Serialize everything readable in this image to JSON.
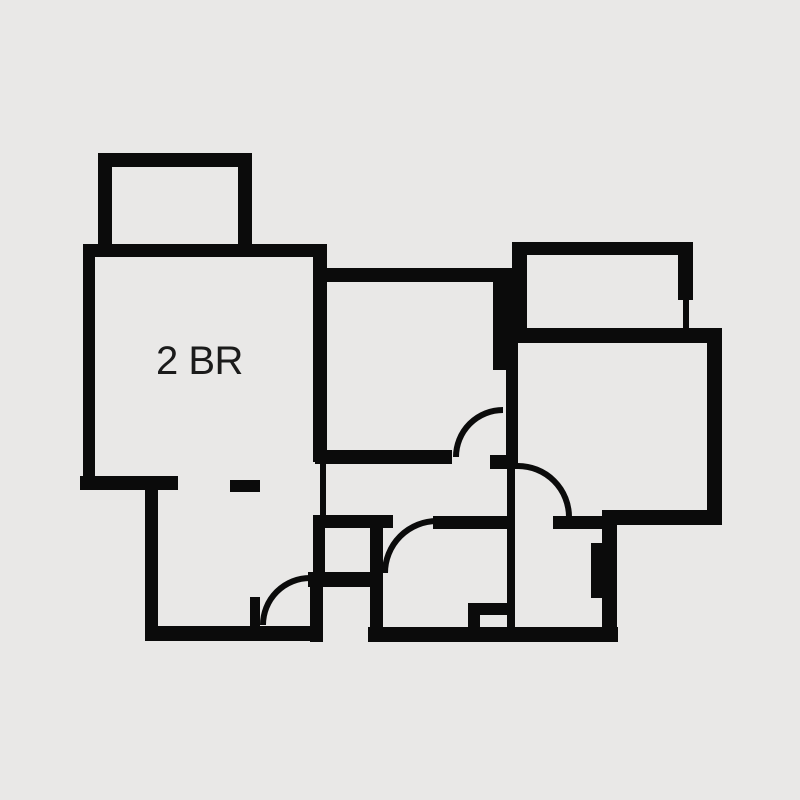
{
  "plan": {
    "label": "2 BR",
    "background_color": "#e9e8e7",
    "wall_color": "#0b0b0b",
    "label_color": "#1b1b1b",
    "door_stroke_width": 6,
    "walls": [
      {
        "name": "tl-balcony-top",
        "x": 98,
        "y": 153,
        "w": 154,
        "h": 14
      },
      {
        "name": "tl-balcony-left",
        "x": 98,
        "y": 167,
        "w": 14,
        "h": 78
      },
      {
        "name": "tl-balcony-right",
        "x": 238,
        "y": 167,
        "w": 14,
        "h": 78
      },
      {
        "name": "bedroom-top",
        "x": 83,
        "y": 244,
        "w": 244,
        "h": 13
      },
      {
        "name": "bedroom-left",
        "x": 83,
        "y": 244,
        "w": 12,
        "h": 246
      },
      {
        "name": "left-step",
        "x": 80,
        "y": 476,
        "w": 98,
        "h": 14
      },
      {
        "name": "left-lower",
        "x": 145,
        "y": 490,
        "w": 13,
        "h": 151
      },
      {
        "name": "bottom-left",
        "x": 145,
        "y": 626,
        "w": 178,
        "h": 15
      },
      {
        "name": "threshold-dash",
        "x": 230,
        "y": 480,
        "w": 30,
        "h": 12
      },
      {
        "name": "divider-bedroom-living",
        "x": 313,
        "y": 244,
        "w": 14,
        "h": 218
      },
      {
        "name": "living-top",
        "x": 327,
        "y": 268,
        "w": 191,
        "h": 14
      },
      {
        "name": "center-block",
        "x": 493,
        "y": 268,
        "w": 25,
        "h": 102
      },
      {
        "name": "center-upper-thin",
        "x": 506,
        "y": 368,
        "w": 12,
        "h": 97
      },
      {
        "name": "living-bottom",
        "x": 315,
        "y": 450,
        "w": 137,
        "h": 14
      },
      {
        "name": "junction-block",
        "x": 490,
        "y": 455,
        "w": 28,
        "h": 14
      },
      {
        "name": "center-lower-thin",
        "x": 507,
        "y": 469,
        "w": 8,
        "h": 158
      },
      {
        "name": "hall-thin-left",
        "x": 320,
        "y": 462,
        "w": 6,
        "h": 53
      },
      {
        "name": "hall-bottom-left",
        "x": 313,
        "y": 515,
        "w": 80,
        "h": 13
      },
      {
        "name": "hall-bottom-mid",
        "x": 433,
        "y": 516,
        "w": 74,
        "h": 13
      },
      {
        "name": "hall-bottom-right",
        "x": 553,
        "y": 516,
        "w": 50,
        "h": 13
      },
      {
        "name": "shaft-left",
        "x": 313,
        "y": 515,
        "w": 12,
        "h": 57
      },
      {
        "name": "shaft-bottom",
        "x": 308,
        "y": 572,
        "w": 75,
        "h": 15
      },
      {
        "name": "shaft-right",
        "x": 370,
        "y": 515,
        "w": 13,
        "h": 127
      },
      {
        "name": "entry-side",
        "x": 310,
        "y": 587,
        "w": 13,
        "h": 55
      },
      {
        "name": "entry-door-stub",
        "x": 250,
        "y": 597,
        "w": 10,
        "h": 29
      },
      {
        "name": "bottom-center",
        "x": 368,
        "y": 627,
        "w": 250,
        "h": 15
      },
      {
        "name": "tr-balcony-top",
        "x": 512,
        "y": 242,
        "w": 181,
        "h": 13
      },
      {
        "name": "tr-balcony-left",
        "x": 512,
        "y": 255,
        "w": 15,
        "h": 73
      },
      {
        "name": "tr-balcony-right",
        "x": 678,
        "y": 242,
        "w": 15,
        "h": 58
      },
      {
        "name": "tr-balcony-right-thin",
        "x": 683,
        "y": 300,
        "w": 6,
        "h": 28
      },
      {
        "name": "right-room-top",
        "x": 512,
        "y": 328,
        "w": 210,
        "h": 15
      },
      {
        "name": "right-room-right",
        "x": 707,
        "y": 343,
        "w": 15,
        "h": 182
      },
      {
        "name": "right-room-bottom",
        "x": 603,
        "y": 510,
        "w": 119,
        "h": 15
      },
      {
        "name": "br-room-right",
        "x": 602,
        "y": 510,
        "w": 15,
        "h": 132
      },
      {
        "name": "br-protrusion",
        "x": 591,
        "y": 543,
        "w": 11,
        "h": 55
      },
      {
        "name": "pocket-vertical",
        "x": 468,
        "y": 603,
        "w": 12,
        "h": 24
      },
      {
        "name": "pocket-horizontal",
        "x": 468,
        "y": 603,
        "w": 39,
        "h": 12
      }
    ],
    "doors": [
      {
        "name": "door-arc-living",
        "x1": 456,
        "y1": 457,
        "x2": 503,
        "y2": 410,
        "r": 47
      },
      {
        "name": "door-arc-right-room",
        "x1": 518,
        "y1": 466,
        "x2": 569,
        "y2": 517,
        "r": 51
      },
      {
        "name": "door-arc-bathroom",
        "x1": 385,
        "y1": 573,
        "x2": 437,
        "y2": 521,
        "r": 52
      },
      {
        "name": "door-arc-entry",
        "x1": 263,
        "y1": 625,
        "x2": 310,
        "y2": 578,
        "r": 47
      }
    ]
  }
}
